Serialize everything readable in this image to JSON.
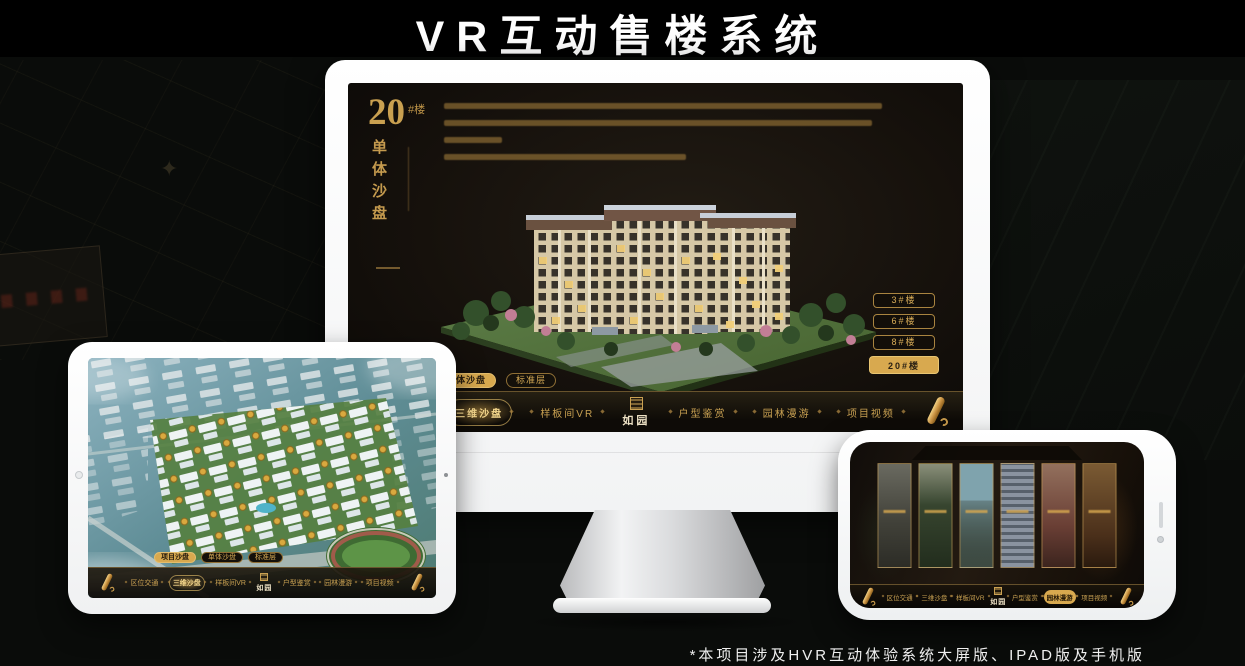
{
  "header": {
    "title": "VR互动售楼系统"
  },
  "footer": {
    "note": "*本项目涉及HVR互动体验系统大屏版、IPAD版及手机版"
  },
  "colors": {
    "accent_gold": "#d8a94f",
    "gold_text": "#c9a152",
    "screen_bg": "#16110c",
    "canvas_bg": "#0a0c0a",
    "device_white": "#ffffff"
  },
  "app": {
    "logo": "如园",
    "nav_items": [
      "区位交通",
      "三维沙盘",
      "样板间VR",
      "户型鉴赏",
      "园林漫游",
      "项目视频"
    ],
    "sub_tabs": [
      "项目沙盘",
      "单体沙盘",
      "标准层"
    ]
  },
  "monitor_app": {
    "title_number": "20",
    "title_suffix": "#楼",
    "subtitle_vertical": "单体沙盘",
    "active_sub_tab": "单体沙盘",
    "active_nav": "三维沙盘",
    "floor_buttons": [
      {
        "label": "3#楼",
        "active": false
      },
      {
        "label": "6#楼",
        "active": false
      },
      {
        "label": "8#楼",
        "active": false
      },
      {
        "label": "20#楼",
        "active": true
      }
    ]
  },
  "tablet_app": {
    "active_sub_tab": "项目沙盘",
    "active_nav": "三维沙盘"
  },
  "phone_app": {
    "active_nav": "园林漫游"
  }
}
